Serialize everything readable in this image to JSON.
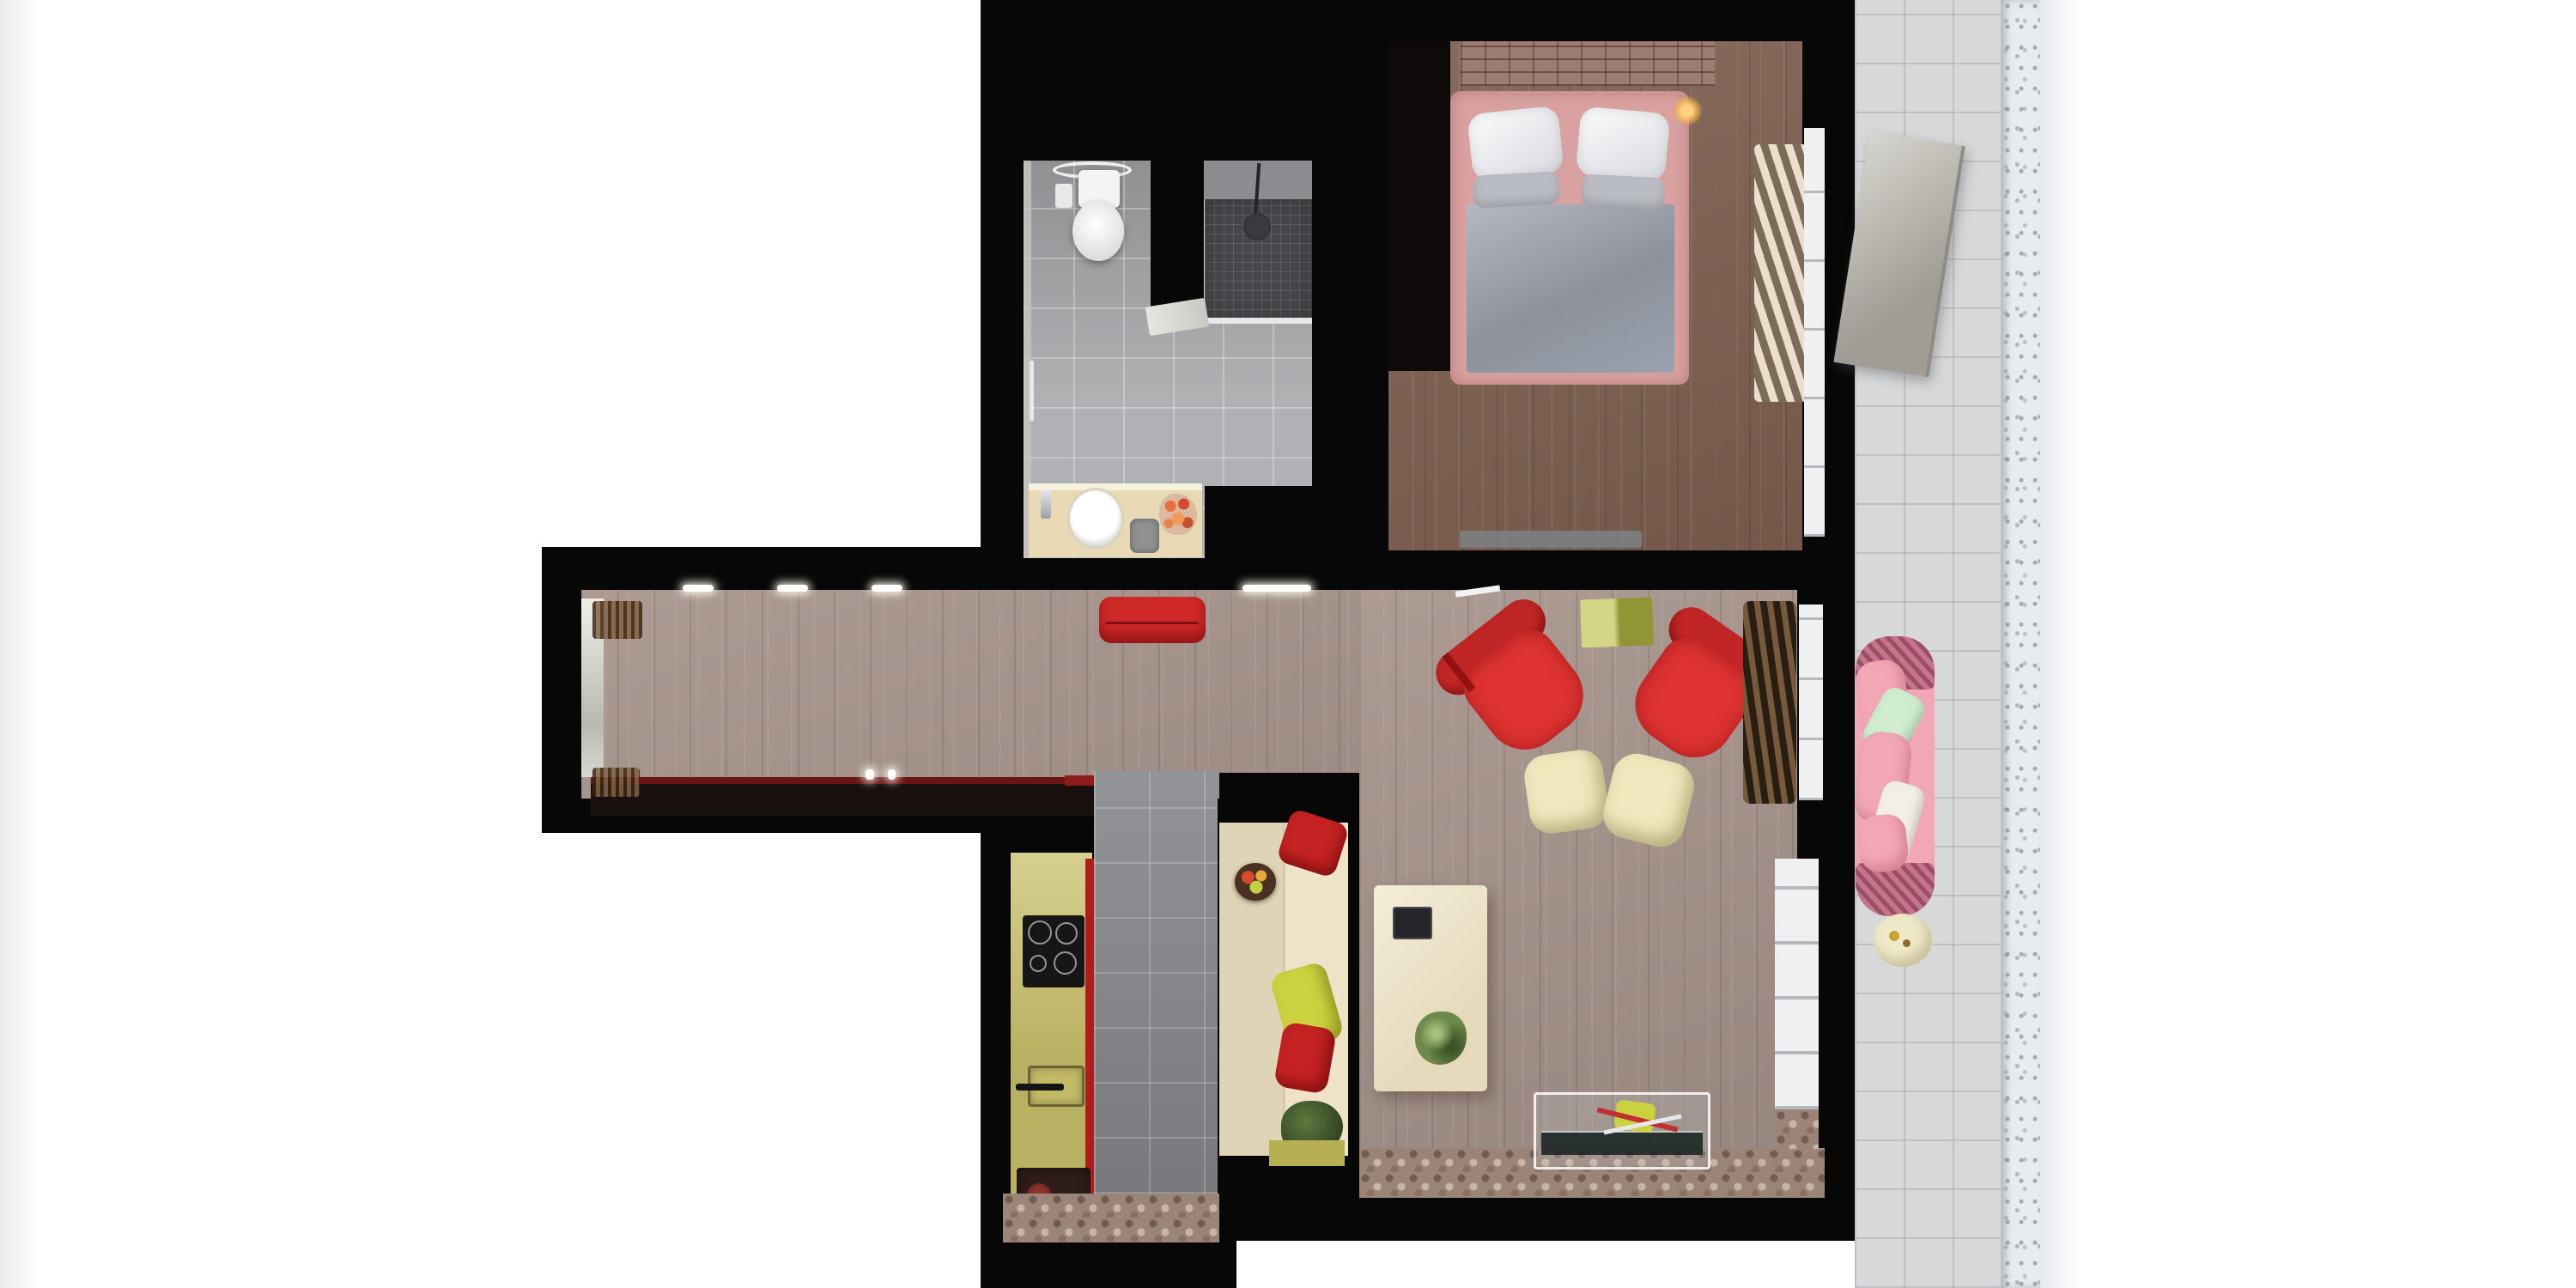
{
  "scene": {
    "title": "Top-down 3D dollhouse render of a one-bedroom apartment with balcony",
    "view": "top-down",
    "background": "#ffffff"
  },
  "palette": {
    "wall": "#070707",
    "wall_soft": "#0d0a09",
    "bedroom_floor": "#7d5f50",
    "living_floor": "#a5928a",
    "bath_floor": "#a7a8ab",
    "shower_wall": "#8b8c8f",
    "shower_tile": "#47474b",
    "toilet_white": "#f4f4f4",
    "vanity_beige": "#e8d9b4",
    "kitchen_counter": "#c9c06a",
    "kitchen_tile": "#85878b",
    "mosaic_floor": "#9b8478",
    "bench_cream": "#ecdfc0",
    "dining_table": "#eee3c4",
    "armchair_red": "#dd3332",
    "armchair_red_dark": "#c12626",
    "pouf_cream": "#efe8bc",
    "olive_table": "#c1c44e",
    "pillow_yellow": "#ccd23f",
    "pillow_red": "#c42222",
    "hall_bench_red": "#cf2828",
    "console_dark": "#17100f",
    "console_red_top": "#6a1414",
    "console_red_bright": "#8e1c1c",
    "curtain_beige": "#c9b8a3",
    "curtain_brown": "#5a4431",
    "bed_frame_pink": "#d9a2a0",
    "duvet_gray": "#9aa0ab",
    "pillow_gray": "#b9bcc2",
    "headboard_brick": "#9b7e71",
    "balcony_tile": "#d7d8da",
    "balcony_panel": "#b7b3aa",
    "sofa_pink": "#f2a7b4",
    "sofa_wicker": "#c4758a",
    "pillow_mint": "#cfeccf",
    "pillow_cream": "#f3efe6",
    "side_table_cream": "#efe9c8",
    "plant_green": "#6c8a4a",
    "window_white": "#eef0f1",
    "balustrade": "#e9ecee",
    "accent_red_strip": "#b01c1c",
    "stool_gray": "#8f9092",
    "cooktop_black": "#161616",
    "appliance_box": "#2f1d1a",
    "fruit_plate": "#4a3020",
    "bench_base_olive": "#b6b053",
    "glass_tint": "rgba(200,216,220,0.18)",
    "glass_shelf": "#13211f",
    "lamp_gold": "#f7b43e"
  },
  "rooms": {
    "bathroom": {
      "label": "Bathroom",
      "items": [
        "ceiling light ring",
        "toilet",
        "walk-in shower with dark mosaic",
        "glass screen",
        "open door",
        "beige vanity",
        "round sink",
        "chrome faucet",
        "orange flowers",
        "gray stool",
        "towel rail"
      ]
    },
    "bedroom": {
      "label": "Bedroom",
      "items": [
        "double bed with pink upholstered frame",
        "two white pillows",
        "two gray pillows",
        "gray duvet",
        "brick headboard wall",
        "gold bedside lamp",
        "foot bench",
        "pleated beige curtain",
        "window"
      ]
    },
    "hallway": {
      "label": "Hallway",
      "items": [
        "mirror with light",
        "wardrobe fringe",
        "dark console with red top",
        "candles",
        "red round bench",
        "ceiling spot lights"
      ]
    },
    "kitchen": {
      "label": "Kitchen",
      "items": [
        "olive cabinet run",
        "induction cooktop",
        "sink with black handle",
        "red accent edge",
        "dark storage box",
        "gray tiled walkway",
        "mosaic entry floor"
      ]
    },
    "living_dining": {
      "label": "Living / dining room",
      "items": [
        "two red swivel armchairs",
        "olive side table",
        "two cream poufs",
        "cream banquette",
        "red cushion",
        "yellow cushion",
        "fruit plate",
        "potted plant",
        "cream dining table with dark tablet and plant",
        "glass console table",
        "brown fringed drape",
        "two windows",
        "mosaic floor border"
      ]
    },
    "balcony": {
      "label": "Balcony",
      "items": [
        "light gray tile floor",
        "leaning gray panel",
        "pink wicker sofa",
        "mint pillow",
        "cream pillow",
        "round cream side table",
        "ornate white balustrade"
      ]
    }
  }
}
